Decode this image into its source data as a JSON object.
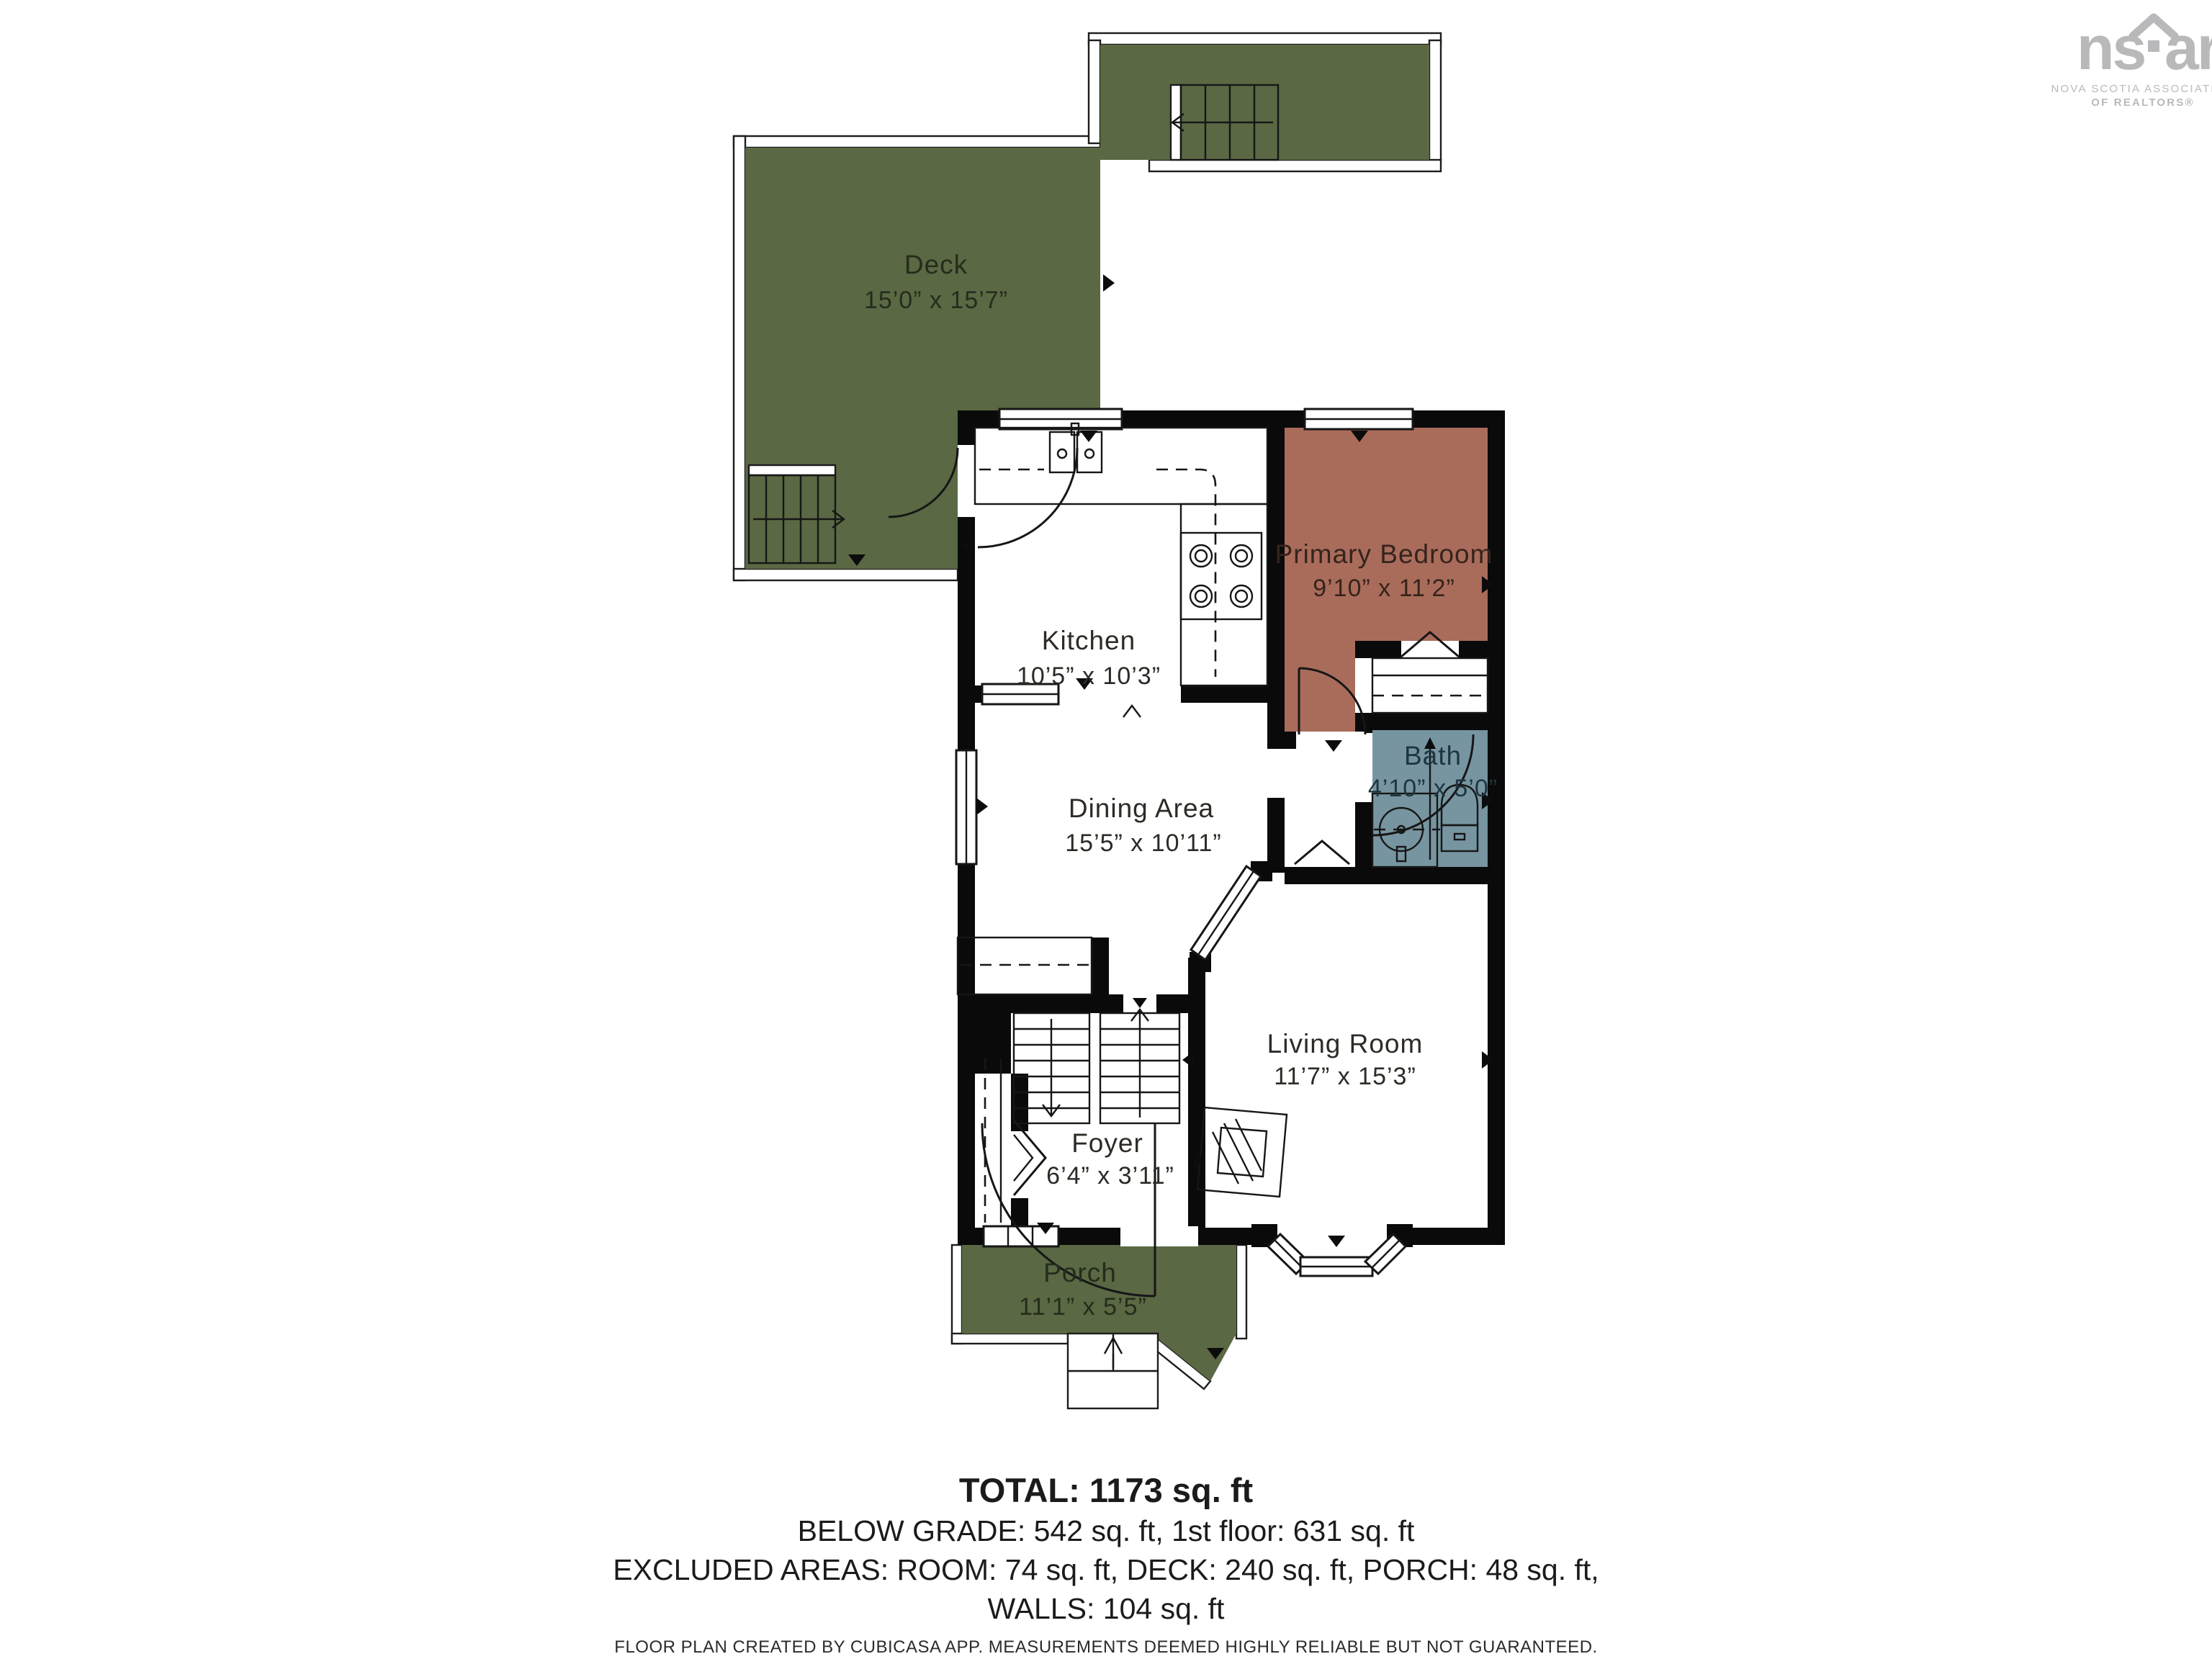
{
  "palette": {
    "deck_green": "#5A6843",
    "porch_green": "#5A6843",
    "bedroom_terracotta": "#A96C5B",
    "bath_blue": "#7795A0",
    "wall_black": "#0A0A0A",
    "label_dark": "#2E2B26",
    "label_on_green": "#262C1C",
    "label_on_terracotta": "#36231C",
    "label_on_blue": "#1E3640",
    "logo_gray": "#B9B9BB"
  },
  "rooms": {
    "deck": {
      "name": "Deck",
      "dims": "15’0” x 15’7”"
    },
    "kitchen": {
      "name": "Kitchen",
      "dims": "10’5” x 10’3”"
    },
    "primary_bedroom": {
      "name": "Primary Bedroom",
      "dims": "9’10” x 11’2”"
    },
    "bath": {
      "name": "Bath",
      "dims": "4’10” x 5’0”"
    },
    "dining": {
      "name": "Dining Area",
      "dims": "15’5” x 10’11”"
    },
    "living": {
      "name": "Living Room",
      "dims": "11’7” x 15’3”"
    },
    "foyer": {
      "name": "Foyer",
      "dims": "6’4” x 3’11”"
    },
    "porch": {
      "name": "Porch",
      "dims": "11’1” x 5’5”"
    }
  },
  "footer": {
    "total": "TOTAL: 1173 sq. ft",
    "line1": "BELOW GRADE: 542 sq. ft, 1st floor: 631 sq. ft",
    "line2": "EXCLUDED AREAS: ROOM: 74 sq. ft, DECK: 240 sq. ft, PORCH: 48 sq. ft,",
    "line3": "WALLS: 104 sq. ft",
    "disclaimer": "FLOOR PLAN CREATED BY CUBICASA APP. MEASUREMENTS DEEMED HIGHLY RELIABLE BUT NOT GUARANTEED."
  },
  "logo": {
    "word_left": "ns",
    "word_right": "ar",
    "assoc_line1": "NOVA SCOTIA ASSOCIATION",
    "assoc_line2": "OF REALTORS®"
  }
}
